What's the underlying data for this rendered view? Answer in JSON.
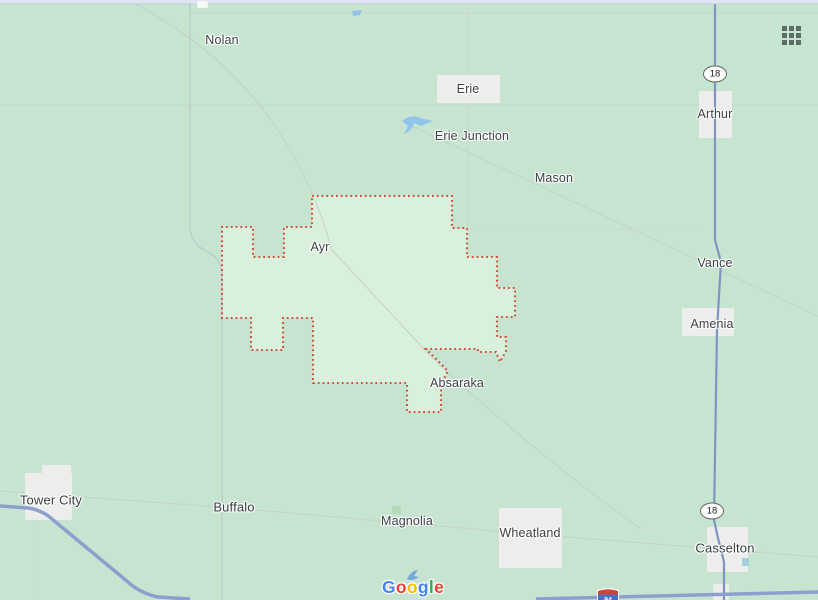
{
  "map": {
    "place_labels": [
      {
        "text": "Nolan"
      },
      {
        "text": "Erie"
      },
      {
        "text": "Erie Junction"
      },
      {
        "text": "Mason"
      },
      {
        "text": "Arthur"
      },
      {
        "text": "Vance"
      },
      {
        "text": "Ayr"
      },
      {
        "text": "Amenia"
      },
      {
        "text": "Absaraka"
      },
      {
        "text": "Tower City"
      },
      {
        "text": "Buffalo"
      },
      {
        "text": "Magnolia"
      },
      {
        "text": "Wheatland"
      },
      {
        "text": "Casselton"
      }
    ],
    "route_shields": [
      {
        "text": "18"
      },
      {
        "text": "18"
      }
    ],
    "interstate_shield": {
      "text": "94"
    },
    "logo_letters": [
      {
        "ch": "G",
        "color": "#4285F4"
      },
      {
        "ch": "o",
        "color": "#EA4335"
      },
      {
        "ch": "o",
        "color": "#FBBC05"
      },
      {
        "ch": "g",
        "color": "#4285F4"
      },
      {
        "ch": "l",
        "color": "#34A853"
      },
      {
        "ch": "e",
        "color": "#EA4335"
      }
    ],
    "icons": {
      "apps_grid": "apps-grid-icon"
    },
    "colors": {
      "map_background": "#c6e4d0",
      "region_fill": "#d9f1dc",
      "region_border": "#d1503a",
      "highway_blue": "#8094c4",
      "interstate_blue": "#8ba0cd",
      "water_blue": "#92c4ea",
      "town_box": "#ededeb",
      "label_text": "#3c4145"
    }
  }
}
